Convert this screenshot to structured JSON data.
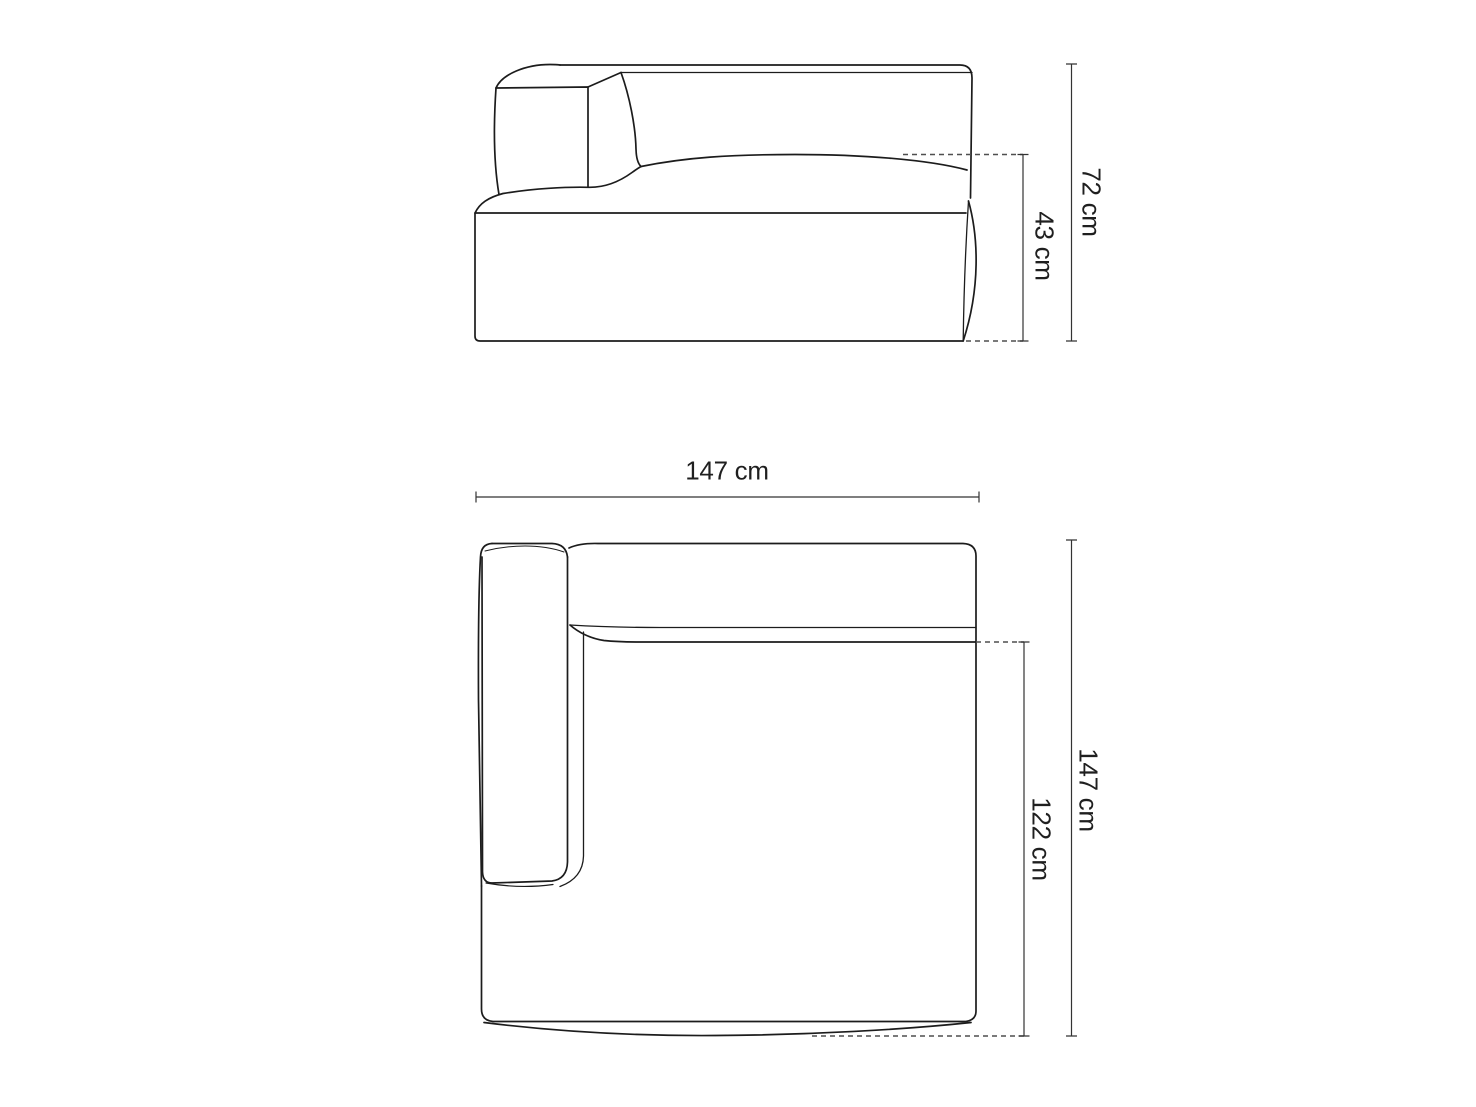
{
  "colors": {
    "background": "#ffffff",
    "outline": "#1c1c1c",
    "detail": "#2a2a2a",
    "dimension": "#333333",
    "dashed": "#4f4f4f",
    "text": "#1f1f1f"
  },
  "labels": {
    "side_height": "72 cm",
    "side_seat_height": "43 cm",
    "top_width": "147 cm",
    "top_depth": "147 cm",
    "top_seat_depth": "122 cm"
  }
}
